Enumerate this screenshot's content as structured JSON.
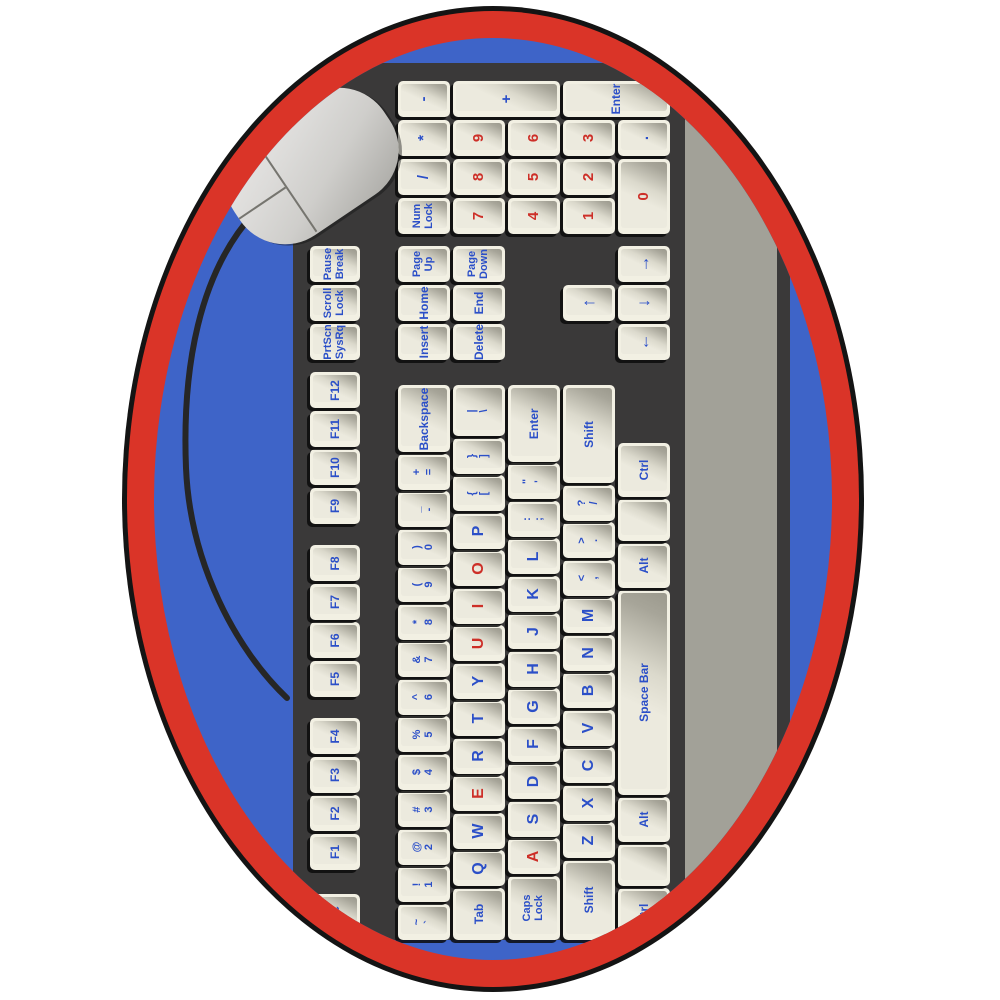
{
  "rug": {
    "shape": "oval",
    "colors": {
      "outline_black": "#141414",
      "border_red": "#da3428",
      "field_blue": "#3e64c8",
      "keyboard_body": "#3a3939",
      "wrist_rest_gray": "#a2a198",
      "keycap_cream": "#f2f0e3",
      "legend_blue": "#2b4fc8",
      "legend_red": "#cd2f28",
      "mouse_gray": "#d6d5d2",
      "cord_black": "#262626"
    }
  },
  "keyboard": {
    "function_row": [
      "Esc",
      "F1",
      "F2",
      "F3",
      "F4",
      "F5",
      "F6",
      "F7",
      "F8",
      "F9",
      "F10",
      "F11",
      "F12",
      "PrtScn\nSysRq",
      "Scroll\nLock",
      "Pause\nBreak"
    ],
    "row1": [
      "~\n`",
      "!\n1",
      "@\n2",
      "#\n3",
      "$\n4",
      "%\n5",
      "^\n6",
      "&\n7",
      "*\n8",
      "(\n9",
      ")\n0",
      "_\n-",
      "+\n=",
      "Backspace"
    ],
    "row2": [
      "Tab",
      "Q",
      "W",
      "E",
      "R",
      "T",
      "Y",
      "U",
      "I",
      "O",
      "P",
      "{\n[",
      "}\n]",
      "|\n\\"
    ],
    "row3": [
      "Caps\nLock",
      "A",
      "S",
      "D",
      "F",
      "G",
      "H",
      "J",
      "K",
      "L",
      ":\n;",
      "\"\n'",
      "Enter"
    ],
    "row4": [
      "Shift",
      "Z",
      "X",
      "C",
      "V",
      "B",
      "N",
      "M",
      "<\n,",
      ">\n.",
      "?\n/",
      "Shift"
    ],
    "row5": [
      "Ctrl",
      "",
      "Alt",
      "Space Bar",
      "Alt",
      "",
      "Ctrl"
    ],
    "nav_row1": [
      "Insert",
      "Home",
      "Page\nUp"
    ],
    "nav_row2": [
      "Delete",
      "End",
      "Page\nDown"
    ],
    "arrows": {
      "up": "↑",
      "left": "←",
      "down": "↓",
      "right": "→"
    },
    "numpad": {
      "row1": [
        "Num\nLock",
        "/",
        "*",
        "-"
      ],
      "row2": [
        "7",
        "8",
        "9"
      ],
      "plus": "+",
      "row3": [
        "4",
        "5",
        "6"
      ],
      "row4": [
        "1",
        "2",
        "3"
      ],
      "enter": "Enter",
      "row5": [
        "0",
        "."
      ]
    },
    "red_letters": [
      "A",
      "E",
      "I",
      "O",
      "U"
    ],
    "red_numpad_digits": true
  },
  "mouse": {
    "present": true,
    "button_count": 2,
    "cord": true
  }
}
